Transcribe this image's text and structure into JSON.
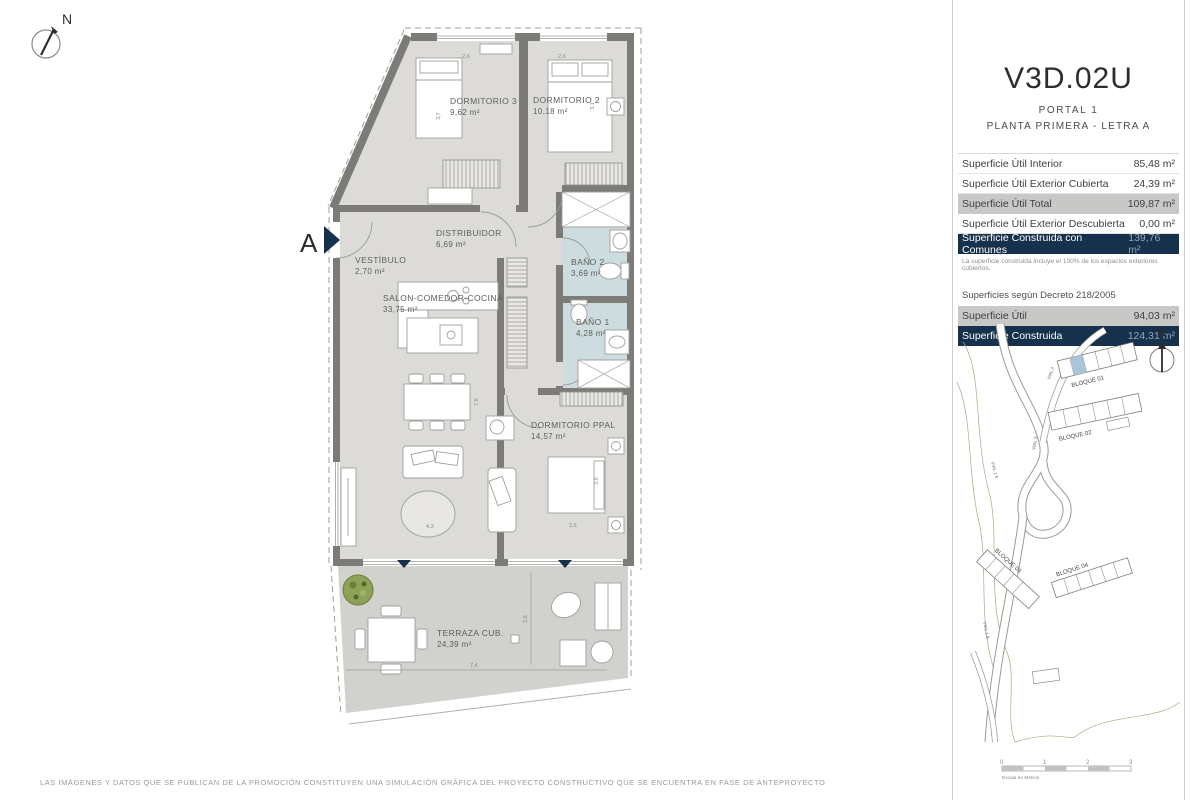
{
  "page": {
    "north": "N",
    "section_marker": "A",
    "footer": "LAS IMÁGENES Y DATOS QUE SE PUBLICAN DE LA PROMOCIÓN CONSTITUYEN UNA SIMULACIÓN GRÁFICA DEL PROYECTO CONSTRUCTIVO QUE SE ENCUENTRA EN FASE DE ANTEPROYECTO"
  },
  "plan": {
    "rooms": [
      {
        "name": "DORMITORIO 3",
        "area": "9,62 m²"
      },
      {
        "name": "DORMITORIO 2",
        "area": "10,18 m²"
      },
      {
        "name": "DISTRIBUIDOR",
        "area": "6,69 m²"
      },
      {
        "name": "VESTÍBULO",
        "area": "2,70 m²"
      },
      {
        "name": "SALON-COMEDOR-COCINA",
        "area": "33,75 m²"
      },
      {
        "name": "BAÑO 2",
        "area": "3,69 m²"
      },
      {
        "name": "BAÑO 1",
        "area": "4,28 m²"
      },
      {
        "name": "DORMITORIO PPAL",
        "area": "14,57 m²"
      },
      {
        "name": "TERRAZA CUB.",
        "area": "24,39 m²"
      }
    ],
    "dims": [
      "2,6",
      "2,6",
      "3,7",
      "3,1",
      "7,8",
      "4,3",
      "3,9",
      "2,6",
      "7,4",
      "2,8"
    ]
  },
  "panel": {
    "title": "V3D.02U",
    "subtitle1": "PORTAL 1",
    "subtitle2": "PLANTA PRIMERA - LETRA A",
    "rows": [
      {
        "label": "Superficie Útil Interior",
        "value": "85,48 m²"
      },
      {
        "label": "Superficie Útil Exterior Cubierta",
        "value": "24,39 m²"
      },
      {
        "label": "Superficie Útil Total",
        "value": "109,87 m²"
      },
      {
        "label": "Superficie Útil Exterior Descubierta",
        "value": "0,00 m²"
      },
      {
        "label": "Superficie Construida con Comunes",
        "value": "139,76 m²"
      }
    ],
    "note": "La superficie construida incluye el 100% de los espacios exteriores cubiertos.",
    "decreto_heading": "Superficies según Decreto 218/2005",
    "decreto_rows": [
      {
        "label": "Superficie Útil",
        "value": "94,03 m²"
      },
      {
        "label": "Superficie Construida",
        "value": "124,31 m²"
      }
    ]
  },
  "siteplan": {
    "north": "N",
    "blocks": [
      "BLOQUE 01",
      "BLOQUE 02",
      "BLOQUE 03",
      "BLOQUE 04"
    ],
    "roads": [
      "VIAL 1 A",
      "VIAL 2",
      "VIAL 3",
      "VIAL 1 B"
    ]
  },
  "scalebar": {
    "ticks": [
      "0",
      "1",
      "2",
      "3"
    ],
    "caption": "Escala en Metros"
  },
  "colors": {
    "navy": "#16314b",
    "gray_row": "#c8c8c6",
    "wall": "#7c7b77",
    "floor": "#dcdbd7",
    "bath_floor": "#ccdcdf",
    "terrace_floor": "#d1d1cd",
    "plant_green": "#8ea157"
  }
}
